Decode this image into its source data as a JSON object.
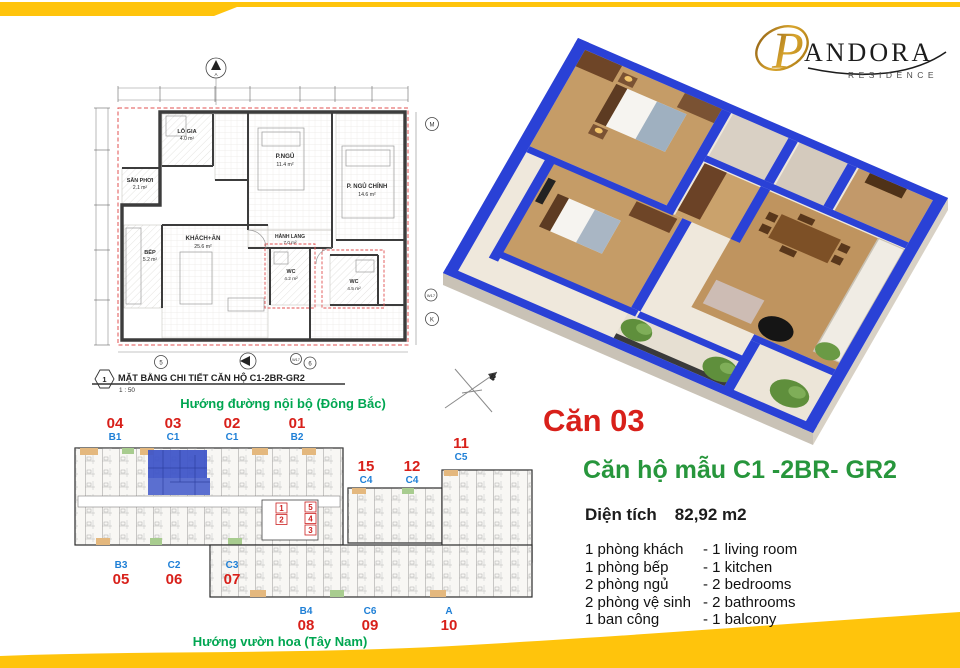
{
  "brand": {
    "script_letter": "P",
    "name": "ANDORA",
    "tagline": "RESIDENCE"
  },
  "detail_plan": {
    "caption": "MẶT BẰNG CHI TIẾT CĂN HỘ C1-2BR-GR2",
    "scale": "1 : 50",
    "marker": "1",
    "north_label": "A",
    "rooms": [
      {
        "name": "LÔ GIA",
        "area": "4.0 m²"
      },
      {
        "name": "SÂN PHƠI",
        "area": "2.1 m²"
      },
      {
        "name": "P.NGỦ",
        "area": "11.4 m²"
      },
      {
        "name": "P. NGỦ CHÍNH",
        "area": "14.6 m²"
      },
      {
        "name": "KHÁCH+ĂN",
        "area": "25.6 m²"
      },
      {
        "name": "BẾP",
        "area": "5.2 m²"
      },
      {
        "name": "WC",
        "area": "4.2 m²"
      },
      {
        "name": "WC",
        "area": "4.5 m²"
      },
      {
        "name": "HÀNH LANG",
        "area": "7.0 m²"
      }
    ],
    "grid_bubbles": {
      "m": "M",
      "k": "K",
      "b5": "5",
      "b6": "6",
      "w17": "W17"
    }
  },
  "site_plan": {
    "direction_top": "Hướng đường nội bộ (Đông Bắc)",
    "direction_bottom": "Hướng vườn hoa (Tây Nam)",
    "compass_letter": "B",
    "top_units": [
      {
        "no": "04",
        "type": "B1"
      },
      {
        "no": "03",
        "type": "C1"
      },
      {
        "no": "02",
        "type": "C1"
      },
      {
        "no": "01",
        "type": "B2"
      }
    ],
    "right_units": [
      {
        "no": "15",
        "type": "C4"
      },
      {
        "no": "12",
        "type": "C4"
      },
      {
        "no": "11",
        "type": "C5"
      }
    ],
    "bottom_left_units": [
      {
        "type": "B3",
        "no": "05"
      },
      {
        "type": "C2",
        "no": "06"
      },
      {
        "type": "C3",
        "no": "07"
      }
    ],
    "bottom_right_units": [
      {
        "type": "B4",
        "no": "08"
      },
      {
        "type": "C6",
        "no": "09"
      },
      {
        "type": "A",
        "no": "10"
      }
    ],
    "core_numbers": [
      "1",
      "2",
      "5",
      "4",
      "3"
    ]
  },
  "info": {
    "unit_label": "Căn 03",
    "title": "Căn hộ mẫu  C1 -2BR- GR2",
    "area_label": "Diện tích",
    "area_value": "82,92 m2",
    "rooms": [
      {
        "vi": "1 phòng khách",
        "en": "- 1 living room"
      },
      {
        "vi": "1 phòng bếp",
        "en": "- 1 kitchen"
      },
      {
        "vi": "2 phòng ngủ",
        "en": "- 2 bedrooms"
      },
      {
        "vi": "2 phòng vệ sinh",
        "en": "- 2 bathrooms"
      },
      {
        "vi": "1 ban công",
        "en": "- 1 balcony"
      }
    ]
  },
  "colors": {
    "accent_yellow": "#FFC40C",
    "unit_red": "#D8201A",
    "type_blue": "#1E7FD6",
    "direction_green": "#00A651",
    "title_green": "#27963C",
    "highlight_blue": "#4056C8",
    "wall_blue": "#2A41D6"
  }
}
